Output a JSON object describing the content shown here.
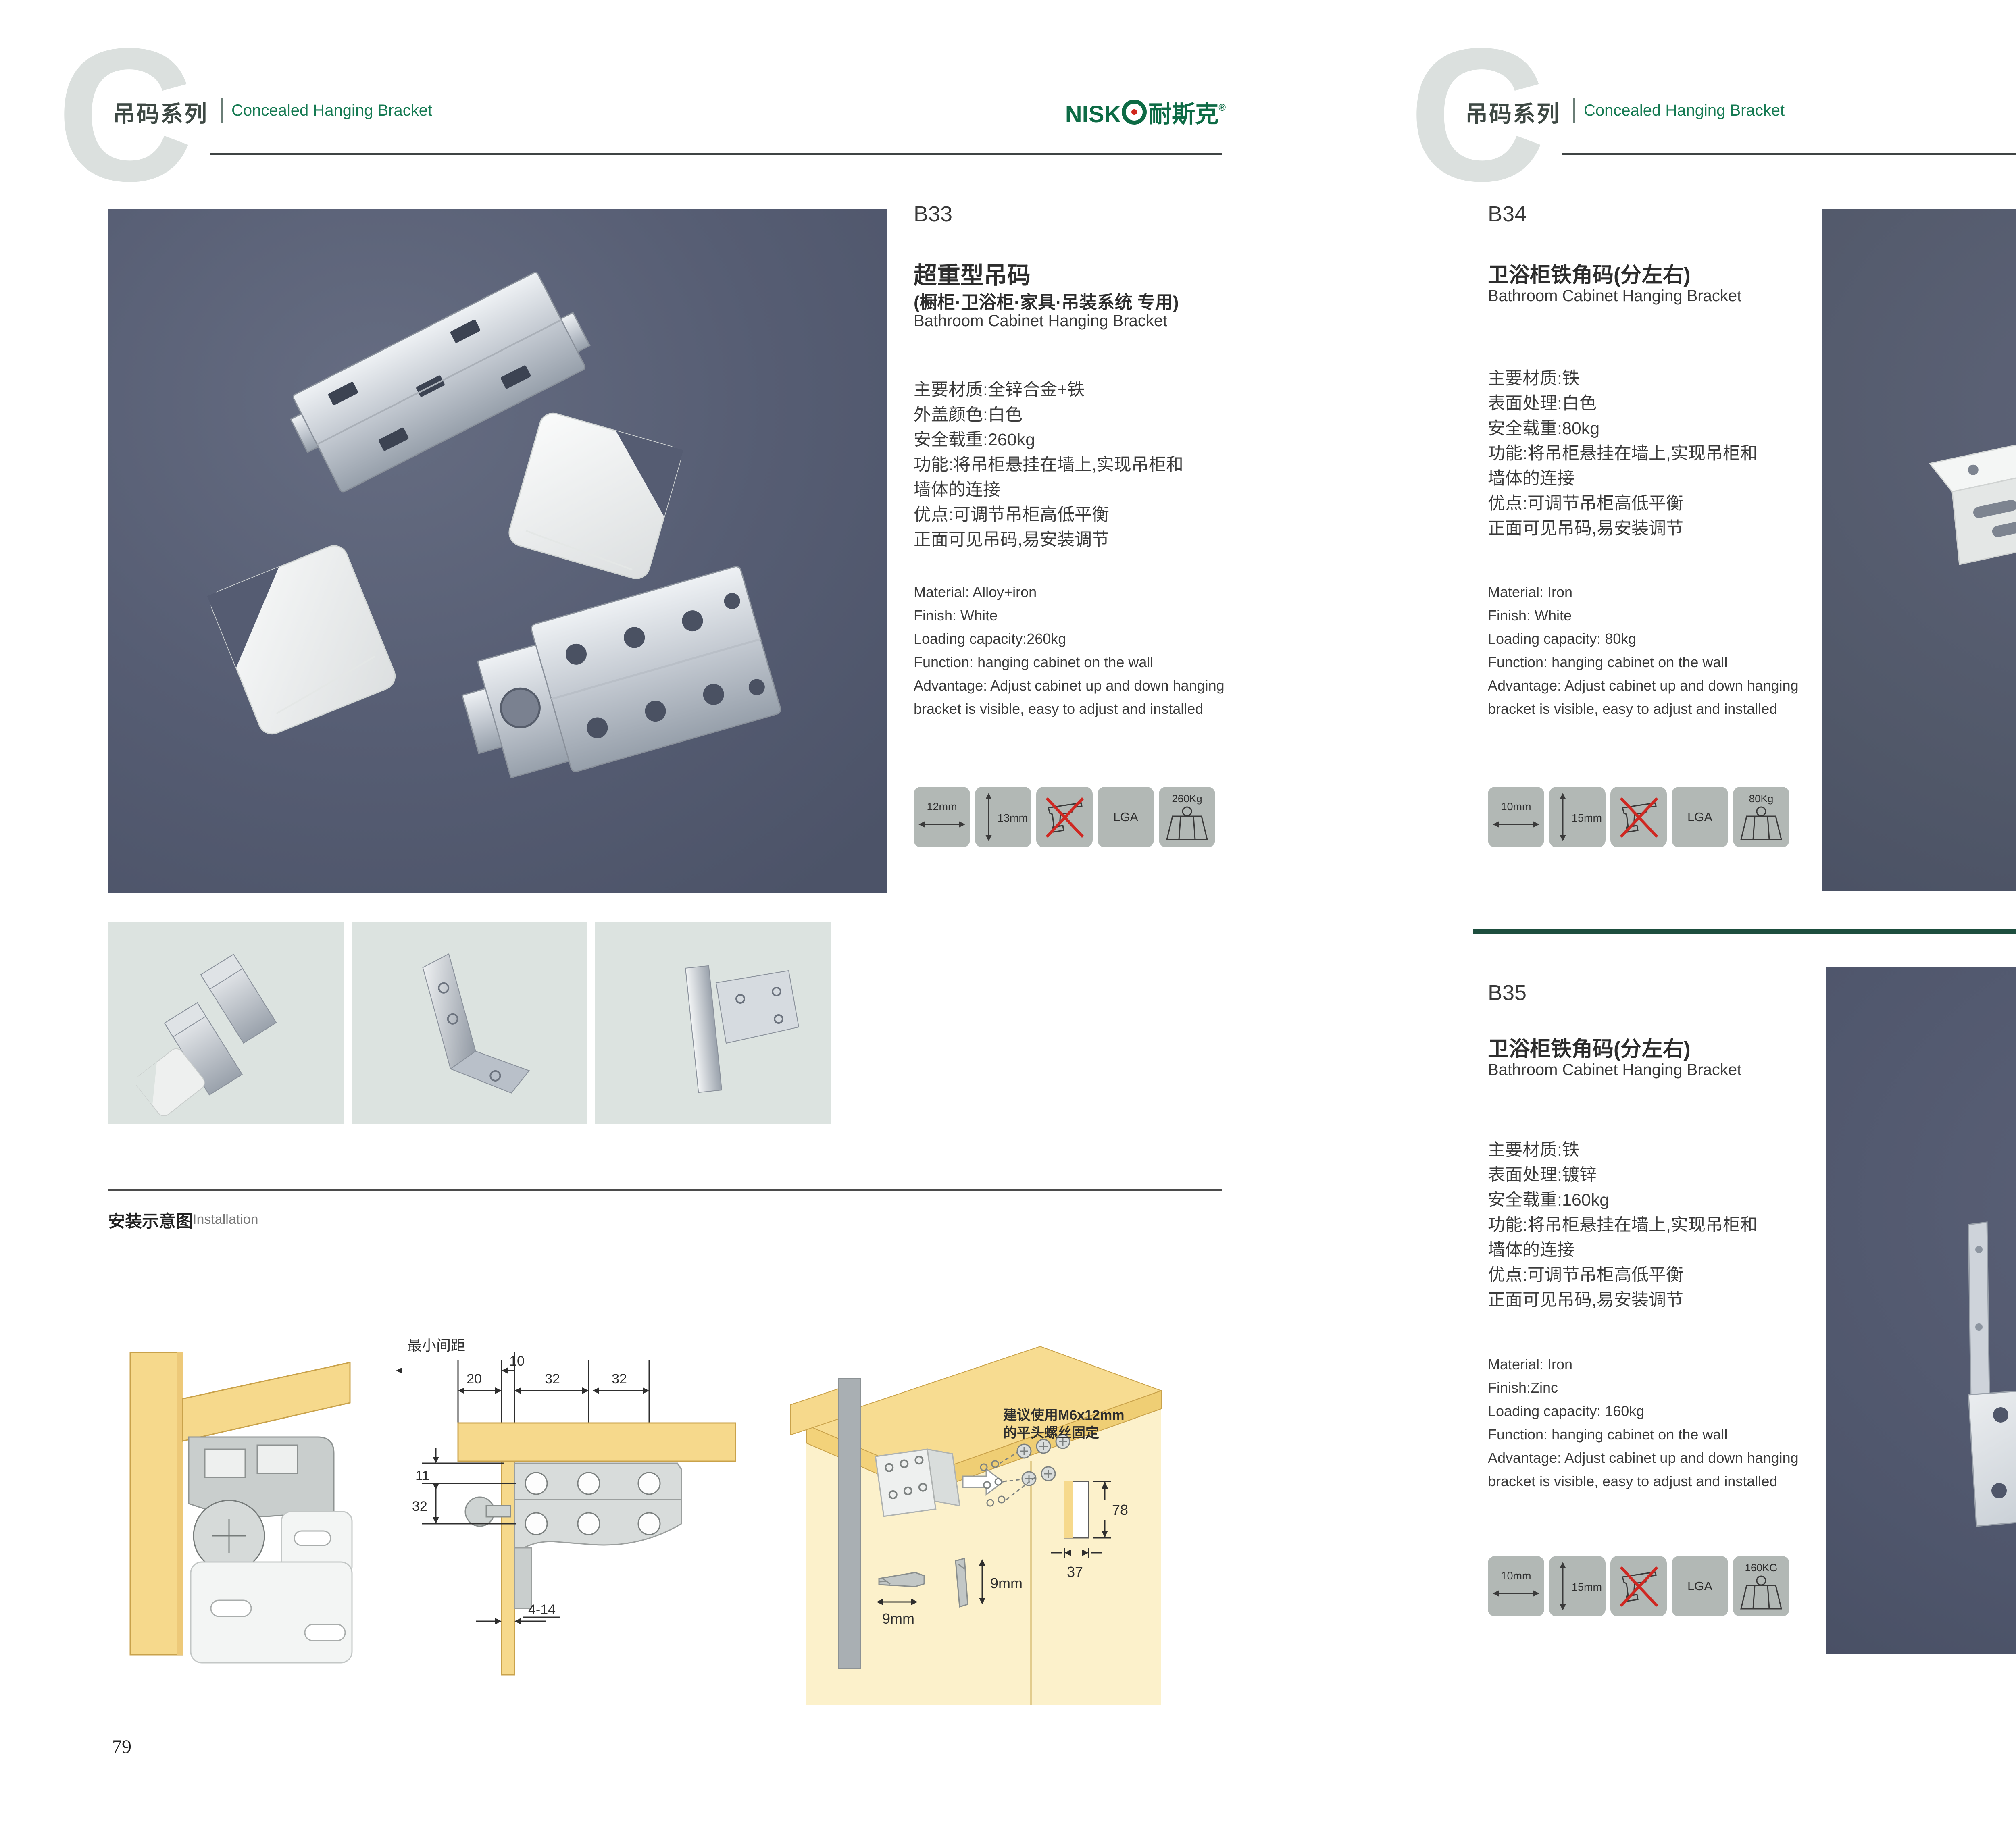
{
  "header": {
    "letter": "C",
    "series_zh": "吊码系列",
    "series_en": "Concealed Hanging Bracket",
    "logo_name": "NISK",
    "logo_zh": "耐斯克",
    "logo_reg": "®"
  },
  "colors": {
    "brand_green": "#0d6b45",
    "accent_red": "#d0261c",
    "photo_slate": "#565d73"
  },
  "page_left": {
    "number": "79"
  },
  "page_right": {
    "number": "80"
  },
  "install": {
    "zh": "安装示意图",
    "en": "Installation"
  },
  "b33": {
    "code": "B33",
    "title_zh": "超重型吊码",
    "subtitle_zh": "(橱柜·卫浴柜·家具·吊装系统 专用)",
    "title_en": "Bathroom Cabinet Hanging Bracket",
    "zh": [
      "主要材质:全锌合金+铁",
      "外盖颜色:白色",
      "安全载重:260kg",
      "功能:将吊柜悬挂在墙上,实现吊柜和",
      "墙体的连接",
      "优点:可调节吊柜高低平衡",
      "正面可见吊码,易安装调节"
    ],
    "en": [
      "Material: Alloy+iron",
      "Finish: White",
      "Loading capacity:260kg",
      "Function: hanging cabinet on the wall",
      "Advantage: Adjust cabinet up and down hanging",
      "bracket is visible, easy to adjust and installed"
    ],
    "icon_width": "12mm",
    "icon_height": "13mm",
    "icon_cert": "LGA",
    "icon_weight": "260Kg"
  },
  "b34": {
    "code": "B34",
    "title_zh": "卫浴柜铁角码(分左右)",
    "title_en": "Bathroom Cabinet Hanging Bracket",
    "zh": [
      "主要材质:铁",
      "表面处理:白色",
      "安全载重:80kg",
      "功能:将吊柜悬挂在墙上,实现吊柜和",
      "墙体的连接",
      "优点:可调节吊柜高低平衡",
      "正面可见吊码,易安装调节"
    ],
    "en": [
      "Material: Iron",
      "Finish: White",
      "Loading capacity: 80kg",
      "Function: hanging cabinet on the wall",
      "Advantage: Adjust cabinet up and down hanging",
      "bracket is visible, easy to adjust and installed"
    ],
    "icon_width": "10mm",
    "icon_height": "15mm",
    "icon_cert": "LGA",
    "icon_weight": "80Kg"
  },
  "b35": {
    "code": "B35",
    "title_zh": "卫浴柜铁角码(分左右)",
    "title_en": "Bathroom Cabinet Hanging Bracket",
    "zh": [
      "主要材质:铁",
      "表面处理:镀锌",
      "安全载重:160kg",
      "功能:将吊柜悬挂在墙上,实现吊柜和",
      "墙体的连接",
      "优点:可调节吊柜高低平衡",
      "正面可见吊码,易安装调节"
    ],
    "en": [
      "Material: Iron",
      "Finish:Zinc",
      "Loading capacity: 160kg",
      "Function: hanging cabinet on the wall",
      "Advantage: Adjust cabinet up and down hanging",
      "bracket is visible, easy to adjust and installed"
    ],
    "icon_width": "10mm",
    "icon_height": "15mm",
    "icon_cert": "LGA",
    "icon_weight": "160KG"
  },
  "diagram2": {
    "min_label": "最小间距",
    "d20": "20",
    "d10": "10",
    "d32a": "32",
    "d32b": "32",
    "d11": "11",
    "d32c": "32",
    "d414": "4-14"
  },
  "diagram3": {
    "note1": "建议使用M6x12mm",
    "note2": "的平头螺丝固定",
    "d78": "78",
    "d37": "37",
    "d9a": "9mm",
    "d9b": "9mm"
  }
}
